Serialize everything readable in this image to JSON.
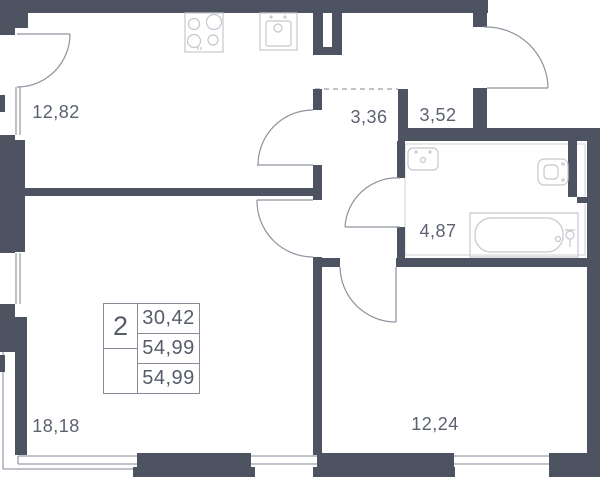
{
  "plan": {
    "type": "apartment floor plan",
    "rooms": [
      {
        "name": "kitchen-living-room",
        "area": "12,82"
      },
      {
        "name": "hallway",
        "area": "3,36"
      },
      {
        "name": "entry-hall",
        "area": "3,52"
      },
      {
        "name": "bathroom",
        "area": "4,87"
      },
      {
        "name": "living-room",
        "area": "18,18"
      },
      {
        "name": "bedroom",
        "area": "12,24"
      }
    ],
    "info_box": {
      "rooms_count": "2",
      "values": [
        "30,42",
        "54,99",
        "54,99"
      ]
    },
    "fixtures": [
      "stove",
      "kitchen-sink",
      "washbasin",
      "toilet",
      "bathtub"
    ],
    "colors": {
      "wall": "#4d5360",
      "thin_line": "#9ba0aa",
      "door_line": "#8d929d",
      "fixture_line": "#c4c7ce",
      "text": "#5b6170",
      "background": "#ffffff"
    }
  }
}
